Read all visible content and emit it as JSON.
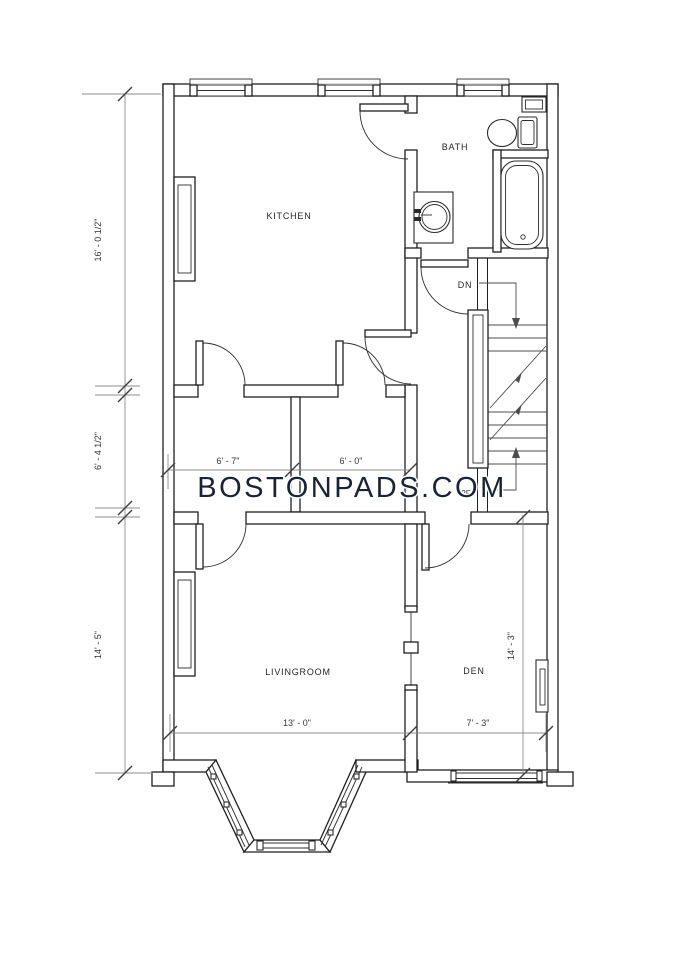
{
  "watermark": {
    "text": "BOSTONPADS.COM",
    "color": "#1a2236",
    "floor_tag": "2F"
  },
  "rooms": {
    "kitchen": "KITCHEN",
    "bath": "BATH",
    "livingroom": "LIVINGROOM",
    "den": "DEN"
  },
  "stairs": {
    "down_label": "DN"
  },
  "dimensions": {
    "left_upper": "16' - 0 1/2\"",
    "left_middle": "6' - 4 1/2\"",
    "left_lower": "14' - 5\"",
    "closet_left": "6' - 7\"",
    "closet_right": "6' - 0\"",
    "livingroom_width": "13' - 0\"",
    "den_width": "7' - 3\"",
    "den_height": "14' - 3\""
  },
  "colors": {
    "wall_line": "#1f1f1f",
    "dimension_line": "#8c8c8c",
    "tick": "#3f3f3f",
    "label_text": "#262626",
    "watermark_navy": "#1a2236",
    "background": "#ffffff"
  }
}
